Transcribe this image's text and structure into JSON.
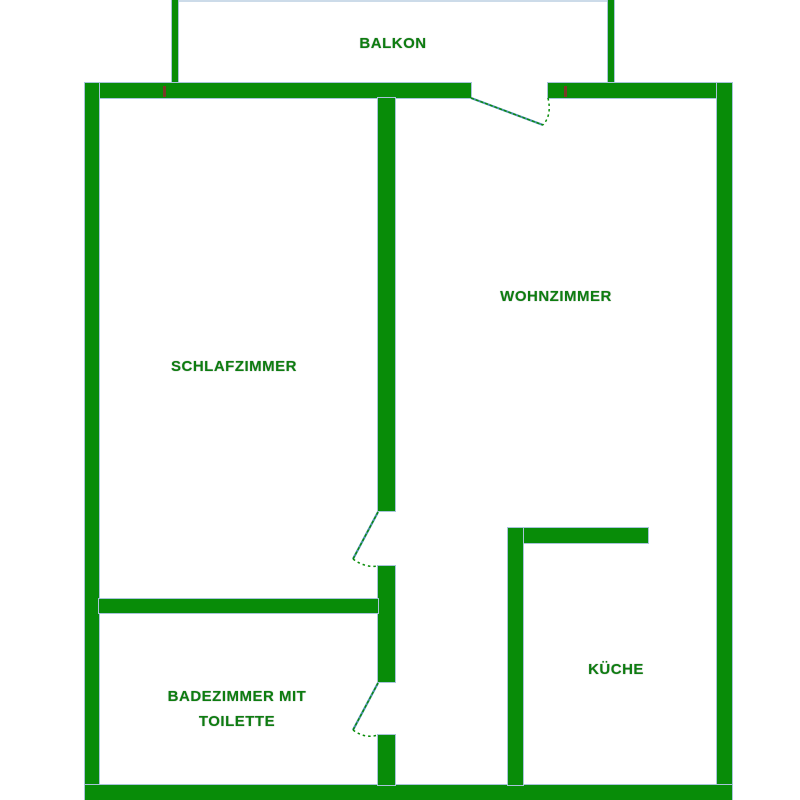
{
  "title": "Apartment floor plan",
  "colors": {
    "wall": "#088c08",
    "edge": "#a8c4da",
    "label": "#0d7d10",
    "balcony_rail": "#ccdbe9",
    "door_leaf": "#4e8fae",
    "mark": "#7a3a28"
  },
  "rooms": {
    "balkon": {
      "label": "BALKON"
    },
    "wohnzimmer": {
      "label": "WOHNZIMMER"
    },
    "schlafzimmer": {
      "label": "SCHLAFZIMMER"
    },
    "kueche": {
      "label": "KÜCHE"
    },
    "badezimmer": {
      "label": "BADEZIMMER MIT TOILETTE"
    }
  }
}
